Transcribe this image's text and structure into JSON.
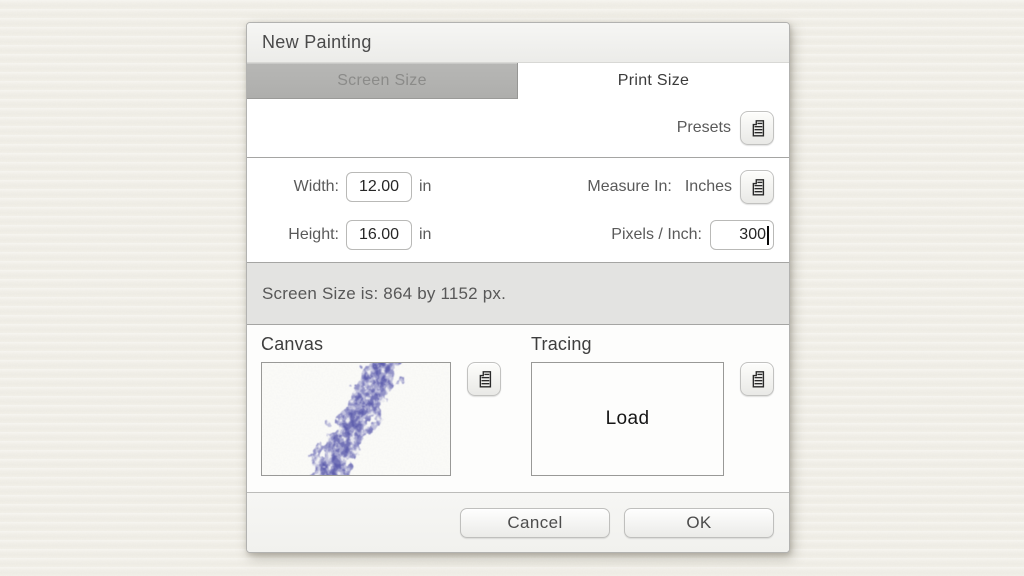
{
  "dialog": {
    "title": "New Painting",
    "tabs": [
      {
        "label": "Screen Size",
        "active": false
      },
      {
        "label": "Print Size",
        "active": true
      }
    ],
    "presets_label": "Presets",
    "fields": {
      "width": {
        "label": "Width:",
        "value": "12.00",
        "unit": "in"
      },
      "height": {
        "label": "Height:",
        "value": "16.00",
        "unit": "in"
      },
      "measure_in": {
        "label": "Measure In:",
        "value": "Inches"
      },
      "ppi": {
        "label": "Pixels / Inch:",
        "value": "300"
      }
    },
    "status_text": "Screen Size is: 864 by 1152 px.",
    "canvas_section": {
      "label": "Canvas"
    },
    "tracing_section": {
      "label": "Tracing",
      "placeholder": "Load"
    },
    "footer": {
      "cancel_label": "Cancel",
      "ok_label": "OK"
    },
    "icons": {
      "menu": "list-menu-icon"
    },
    "colors": {
      "canvas_stroke": "#5b5bae",
      "canvas_stroke_dark": "#4a4aa2",
      "status_bar_bg": "#e3e3e1",
      "inactive_tab_bg": "#b3b3b1"
    }
  }
}
